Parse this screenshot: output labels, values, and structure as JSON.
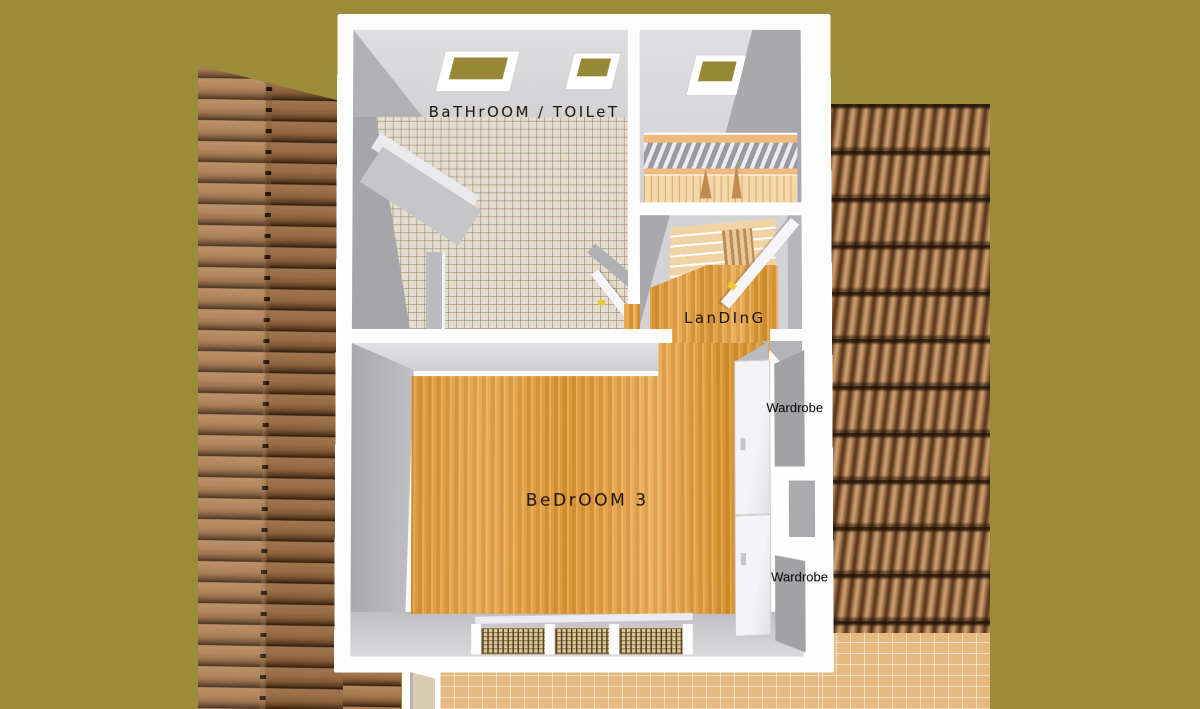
{
  "floor_plan": {
    "rooms": {
      "bathroom": {
        "label": "BaTHrOOM / TOILeT"
      },
      "landing": {
        "label": "LanDInG"
      },
      "bedroom": {
        "label": "BeDrOOM 3"
      }
    },
    "wardrobes": [
      {
        "label": "Wardrobe"
      },
      {
        "label": "Wardrobe"
      }
    ]
  },
  "colors": {
    "background": "#9c8c3a",
    "plan_wall_white": "#fdfdfd",
    "wall_gray_dark": "#a6a6aa",
    "wall_gray_light": "#d8d8da",
    "wood_floor": "#e0a04a",
    "stair_wood": "#f2d4a4",
    "tile_floor": "#e3ddcf",
    "roof_tile_brown": "#a87a50",
    "patio_tan": "#edc289",
    "door_handle_yellow": "#eec832",
    "label_text": "#1d1306",
    "wardrobe_text": "#000000"
  }
}
